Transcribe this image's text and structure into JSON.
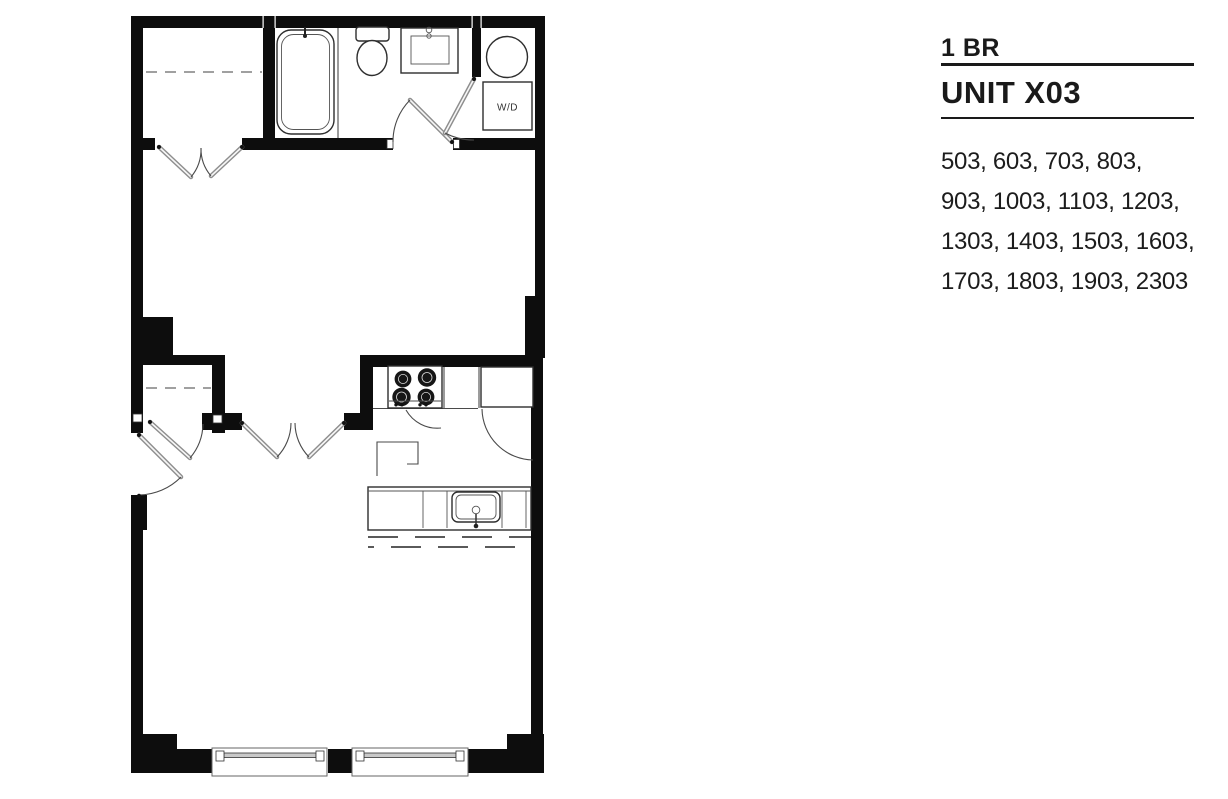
{
  "panel": {
    "bedroom_type": "1 BR",
    "unit_name": "UNIT X03",
    "unit_numbers_lines": [
      "503, 603, 703, 803,",
      "903, 1003, 1103, 1203,",
      "1303, 1403, 1503, 1603,",
      "1703, 1803, 1903, 2303"
    ],
    "unit_numbers": [
      "503",
      "603",
      "703",
      "803",
      "903",
      "1003",
      "1103",
      "1203",
      "1303",
      "1403",
      "1503",
      "1603",
      "1703",
      "1803",
      "1903",
      "2303"
    ]
  },
  "floorplan": {
    "wd_label": "W/D",
    "fixtures": [
      "bathtub",
      "toilet",
      "vanity-sink",
      "washer-dryer",
      "stove",
      "refrigerator",
      "kitchen-island",
      "kitchen-sink",
      "closet-rod",
      "window",
      "door-swing"
    ],
    "colors": {
      "walls": "#0d0d0d",
      "fixture_outline": "#2e2e2e",
      "door_leaf": "#8e8e8e",
      "text": "#1a1a1a",
      "background": "#ffffff"
    }
  }
}
